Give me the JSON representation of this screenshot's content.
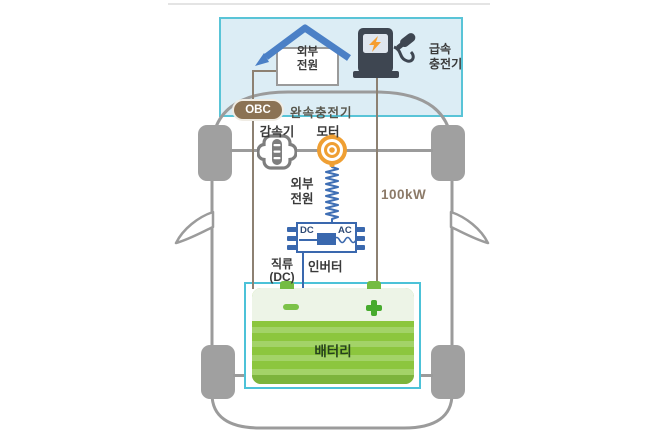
{
  "diagram_title": "EV powertrain and charging diagram",
  "charging_box": {
    "home_power": {
      "line1": "외부",
      "line2": "전원"
    },
    "fast_charger": {
      "line1": "급속",
      "line2": "충전기"
    }
  },
  "obc": {
    "badge": "OBC",
    "label": "완속충전기"
  },
  "drivetrain": {
    "reducer": "감속기",
    "motor": "모터"
  },
  "ac_link": {
    "line1": "외부",
    "line2": "전원",
    "power_rating": "100kW"
  },
  "inverter": {
    "dc": "DC",
    "ac": "AC",
    "name": "인버터",
    "dc_line": {
      "line1": "직류",
      "line2": "(DC)"
    }
  },
  "battery": {
    "label": "배터리",
    "minus_symbol": "-",
    "plus_symbol": "+"
  },
  "colors": {
    "box_border_cyan": "#59c4d7",
    "box_fill_blue": "#dcedf5",
    "battery_zone_cyan": "#4cc2d8",
    "car_gray": "#9b9b9b",
    "wheel_gray": "#a0a0a0",
    "wire_brown": "#8d8172",
    "circuit_blue": "#3a68ae",
    "roof_blue": "#4b80c6",
    "charger_dark": "#3e4651",
    "bolt_orange": "#f59e2f",
    "motor_orange": "#ef9f33",
    "battery_green": "#8cc63e",
    "battery_top_light": "#edf4e7",
    "battery_stripe": "#a3d368",
    "symbol_green": "#47ab2e",
    "obc_brown": "#8b7254",
    "kw_text": "#8c7a68"
  }
}
